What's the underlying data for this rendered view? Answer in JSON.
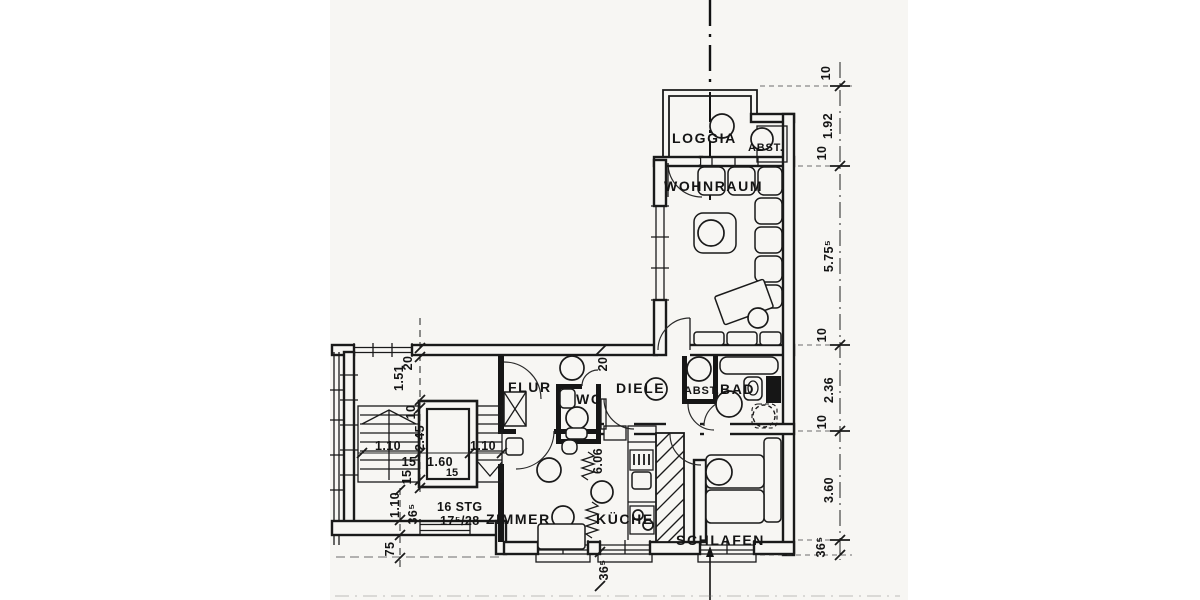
{
  "drawing": {
    "type": "apartment floor plan",
    "paper_color": "#f7f6f3",
    "ink_color": "#1a1a1a"
  },
  "rooms": {
    "loggia": "LOGGIA",
    "abst_loggia": "ABST.",
    "wohnraum": "WOHNRAUM",
    "flur": "FLUR",
    "wc": "WC",
    "diele": "DIELE",
    "abst_bad": "ABST.",
    "bad": "BAD",
    "zimmer": "ZIMMER",
    "kueche": "KÜCHE",
    "schlafen": "SCHLAFEN"
  },
  "stairs": {
    "line1": "16 STG",
    "line2": "17⁵/28"
  },
  "dims": {
    "right": {
      "d10a": "10",
      "d192": "1.92",
      "d10b": "10",
      "d575": "5.75⁵",
      "d10c": "10",
      "d236": "2.36",
      "d10d": "10",
      "d360": "3.60",
      "d365": "36⁵"
    },
    "left": {
      "d20": "20",
      "d151": "1.51",
      "d10": "10",
      "d245": "2.45",
      "d110l": "1.10",
      "d15a": "15",
      "d160": "1.60",
      "d110r": "1.10",
      "d15b": "15",
      "d15c": "15",
      "d110v": "1.10",
      "d365": "36⁵",
      "d75": "75"
    },
    "mid": {
      "d20": "20",
      "d606": "6.06",
      "d365": "36⁵"
    }
  }
}
